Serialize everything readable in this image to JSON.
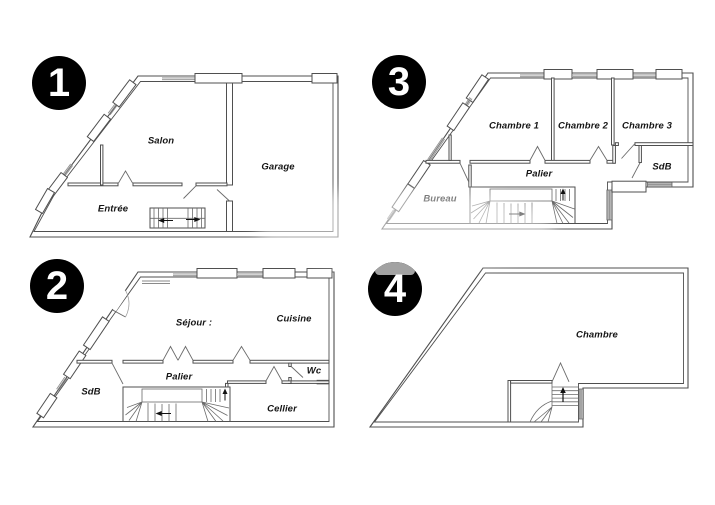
{
  "colors": {
    "background": "#ffffff",
    "wall_line": "#4f4f4f",
    "window_hatch": "#8a8a8a",
    "dark_window_fill": "#b4b4b4",
    "badge_background": "#000000",
    "badge_text": "#ffffff",
    "room_label_text": "#151515",
    "watermark": "#a2a2a2"
  },
  "plans": [
    {
      "number": "1",
      "rooms": [
        {
          "label": "Salon"
        },
        {
          "label": "Garage"
        },
        {
          "label": "Entrée"
        }
      ]
    },
    {
      "number": "2",
      "rooms": [
        {
          "label": "Séjour :"
        },
        {
          "label": "Cuisine"
        },
        {
          "label": "Palier"
        },
        {
          "label": "Wc"
        },
        {
          "label": "SdB"
        },
        {
          "label": "Cellier"
        }
      ]
    },
    {
      "number": "3",
      "rooms": [
        {
          "label": "Chambre 1"
        },
        {
          "label": "Chambre 2"
        },
        {
          "label": "Chambre 3"
        },
        {
          "label": "SdB"
        },
        {
          "label": "Palier"
        },
        {
          "label": "Bureau"
        }
      ]
    },
    {
      "number": "4",
      "rooms": [
        {
          "label": "Chambre"
        }
      ]
    }
  ]
}
